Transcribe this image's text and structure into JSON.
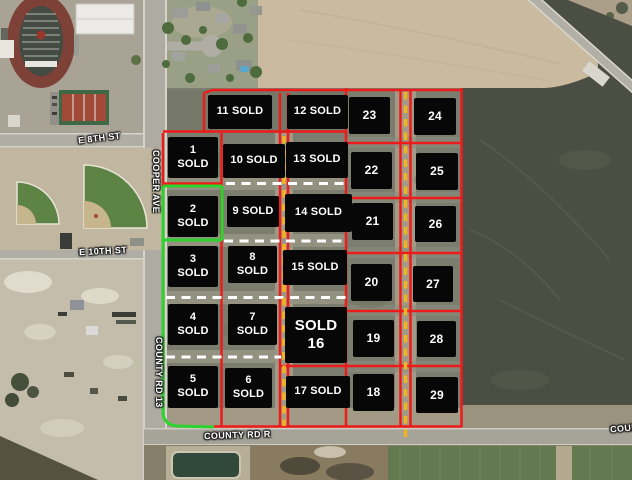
{
  "roads": {
    "e_8th_st": "E 8TH ST",
    "cooper_ave": "COOPER AVE",
    "e_10th_st": "E 10TH ST",
    "county_rd_13": "COUNTY RD 13",
    "county_rd_r": "COUNTY RD R",
    "county_rd_right_edge": "COUNT"
  },
  "overlay_colors": {
    "parcel_boundary_red": "#ee1b1b",
    "parcel_boundary_green": "#2dd32d",
    "divider_dashed_yellow": "#f1b31f",
    "divider_dashed_white": "#ffffff",
    "lot_label_background": "#070707",
    "lot_label_text": "#ffffff"
  },
  "lots": [
    {
      "num": "1",
      "label": "1\nSOLD",
      "status": "sold"
    },
    {
      "num": "2",
      "label": "2\nSOLD",
      "status": "sold"
    },
    {
      "num": "3",
      "label": "3\nSOLD",
      "status": "sold"
    },
    {
      "num": "4",
      "label": "4\nSOLD",
      "status": "sold"
    },
    {
      "num": "5",
      "label": "5\nSOLD",
      "status": "sold"
    },
    {
      "num": "6",
      "label": "6\nSOLD",
      "status": "sold"
    },
    {
      "num": "7",
      "label": "7\nSOLD",
      "status": "sold"
    },
    {
      "num": "8",
      "label": "8\nSOLD",
      "status": "sold"
    },
    {
      "num": "9",
      "label": "9 SOLD",
      "status": "sold"
    },
    {
      "num": "10",
      "label": "10 SOLD",
      "status": "sold"
    },
    {
      "num": "11",
      "label": "11 SOLD",
      "status": "sold"
    },
    {
      "num": "12",
      "label": "12 SOLD",
      "status": "sold"
    },
    {
      "num": "13",
      "label": "13 SOLD",
      "status": "sold"
    },
    {
      "num": "14",
      "label": "14 SOLD",
      "status": "sold"
    },
    {
      "num": "15",
      "label": "15 SOLD",
      "status": "sold"
    },
    {
      "num": "16",
      "label": "SOLD\n16",
      "status": "sold"
    },
    {
      "num": "17",
      "label": "17 SOLD",
      "status": "sold"
    },
    {
      "num": "18",
      "label": "18",
      "status": "available"
    },
    {
      "num": "19",
      "label": "19",
      "status": "available"
    },
    {
      "num": "20",
      "label": "20",
      "status": "available"
    },
    {
      "num": "21",
      "label": "21",
      "status": "available"
    },
    {
      "num": "22",
      "label": "22",
      "status": "available"
    },
    {
      "num": "23",
      "label": "23",
      "status": "available"
    },
    {
      "num": "24",
      "label": "24",
      "status": "available"
    },
    {
      "num": "25",
      "label": "25",
      "status": "available"
    },
    {
      "num": "26",
      "label": "26",
      "status": "available"
    },
    {
      "num": "27",
      "label": "27",
      "status": "available"
    },
    {
      "num": "28",
      "label": "28",
      "status": "available"
    },
    {
      "num": "29",
      "label": "29",
      "status": "available"
    }
  ]
}
